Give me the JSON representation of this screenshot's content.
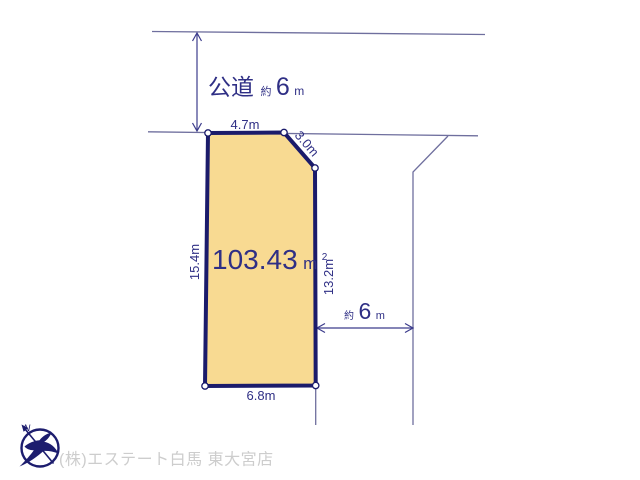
{
  "colors": {
    "background": "#ffffff",
    "parcel_fill": "#f8da92",
    "parcel_border": "#1b1b6b",
    "road_line": "#6f6f9e",
    "dimension_text": "#2f2f85",
    "logo_navy": "#1d1d6e",
    "footer_text": "#cdcdcd"
  },
  "roads": {
    "top": {
      "name": "公道",
      "approx": "約",
      "width_value": "6",
      "width_unit": "m"
    },
    "right": {
      "approx": "約",
      "width_value": "6",
      "width_unit": "m"
    }
  },
  "parcel": {
    "area_value": "103.43",
    "area_unit": "m",
    "area_superscript": "2",
    "dimensions": {
      "top": "4.7m",
      "corner": "3.0m",
      "left": "15.4m",
      "right": "13.2m",
      "bottom": "6.8m"
    }
  },
  "logo": {
    "north_label": "N"
  },
  "footer": {
    "company_name": "(株)エステート白馬 東大宮店"
  }
}
